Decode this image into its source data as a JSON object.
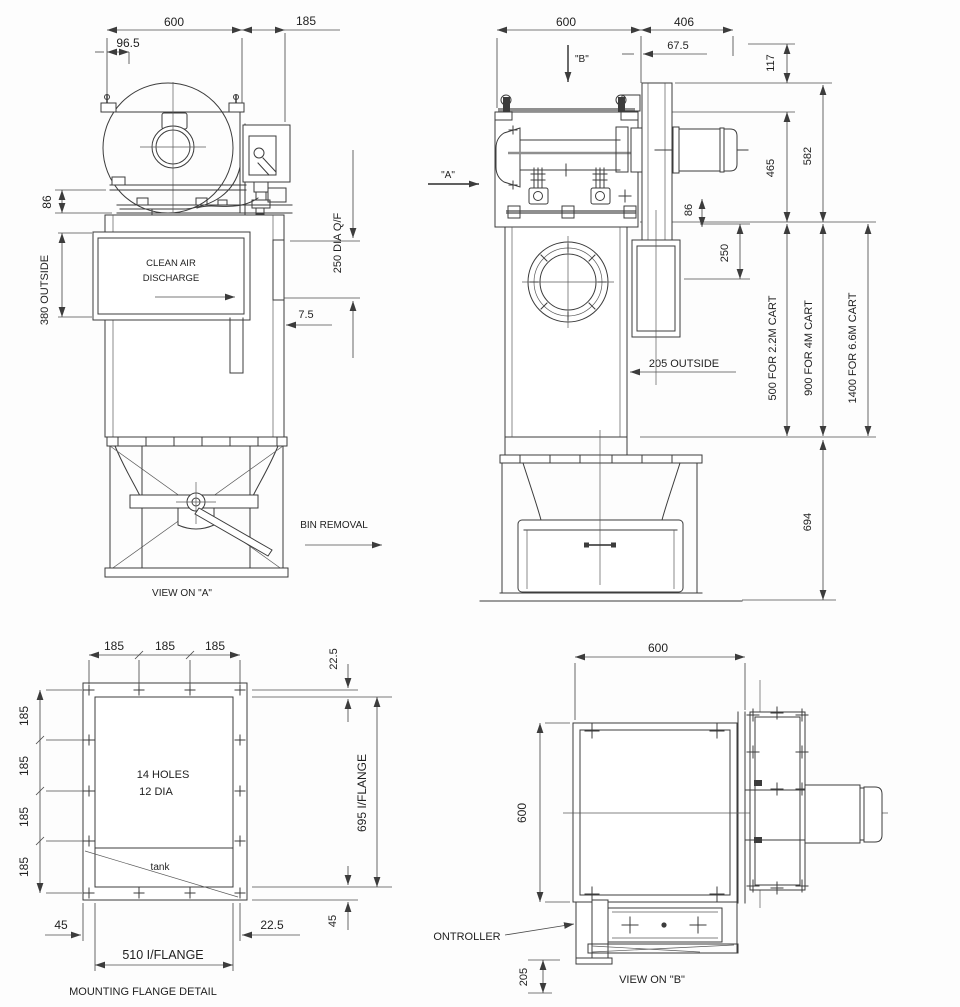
{
  "front_view": {
    "dim_600": "600",
    "dim_96_5": "96.5",
    "dim_185": "185",
    "dim_86": "86",
    "dim_380_outside": "380 OUTSIDE",
    "clean_air_line1": "CLEAN AIR",
    "clean_air_line2": "DISCHARGE",
    "dim_250_dia_qf": "250 DIA Q/F",
    "dim_7_5": "7.5",
    "dim_540": "540",
    "bin_removal_label": "BIN REMOVAL",
    "caption": "VIEW ON \"A\""
  },
  "side_view": {
    "dim_600": "600",
    "dim_406": "406",
    "dim_67_5": "67.5",
    "dim_117": "117",
    "view_b_marker": "\"B\"",
    "view_a_marker": "\"A\"",
    "dim_465": "465",
    "dim_582": "582",
    "dim_86": "86",
    "dim_250": "250",
    "dim_205_outside": "205 OUTSIDE",
    "cart_2_2m": "500 FOR 2.2M CART",
    "cart_4m": "900 FOR 4M CART",
    "cart_6_6m": "1400 FOR 6.6M CART",
    "dim_694": "694"
  },
  "flange_detail": {
    "dim_185_top_1": "185",
    "dim_185_top_2": "185",
    "dim_185_top_3": "185",
    "dim_185_left_1": "185",
    "dim_185_left_2": "185",
    "dim_185_left_3": "185",
    "dim_185_left_4": "185",
    "dim_22_5_top": "22.5",
    "holes_line1": "14 HOLES",
    "holes_line2": "12 DIA",
    "tank_label": "tank",
    "dim_695_iflange": "695 I/FLANGE",
    "dim_45_left": "45",
    "dim_22_5_bottom": "22.5",
    "dim_45_right": "45",
    "dim_510_iflange": "510 I/FLANGE",
    "caption": "MOUNTING FLANGE DETAIL"
  },
  "plan_view": {
    "dim_600_top": "600",
    "dim_600_left": "600",
    "controller_label": "ONTROLLER",
    "dim_205": "205",
    "caption": "VIEW ON \"B\""
  }
}
